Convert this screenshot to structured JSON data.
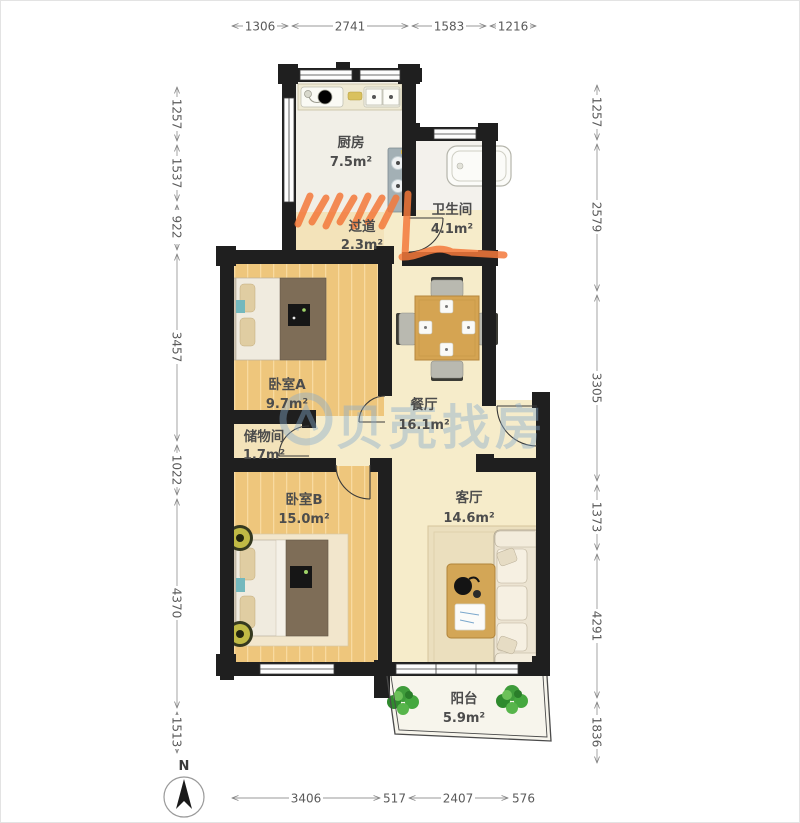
{
  "watermark": {
    "text": "贝壳找房"
  },
  "compass": {
    "label": "N"
  },
  "rooms": [
    {
      "key": "kitchen",
      "name": "厨房",
      "area": "7.5m²"
    },
    {
      "key": "bathroom",
      "name": "卫生间",
      "area": "4.1m²"
    },
    {
      "key": "hallway",
      "name": "过道",
      "area": "2.3m²"
    },
    {
      "key": "bedroom_a",
      "name": "卧室A",
      "area": "9.7m²"
    },
    {
      "key": "storage",
      "name": "储物间",
      "area": "1.7m²"
    },
    {
      "key": "dining",
      "name": "餐厅",
      "area": "16.1m²"
    },
    {
      "key": "bedroom_b",
      "name": "卧室B",
      "area": "15.0m²"
    },
    {
      "key": "living",
      "name": "客厅",
      "area": "14.6m²"
    },
    {
      "key": "balcony",
      "name": "阳台",
      "area": "5.9m²"
    }
  ],
  "dimensions_mm": {
    "top": [
      "1306",
      "2741",
      "1583",
      "1216"
    ],
    "left": [
      "1257",
      "1537",
      "922",
      "3457",
      "1022",
      "4370",
      "1513"
    ],
    "right": [
      "1257",
      "2579",
      "3305",
      "1373",
      "4291",
      "1836"
    ],
    "bottom": [
      "3406",
      "517",
      "2407",
      "576"
    ]
  },
  "colors": {
    "wall": "#1f1f1f",
    "wood_floor": "#eec67c",
    "tile_floor": "#f1efe7",
    "cream_floor": "#f6ecca",
    "hall_floor": "#f3e3ba",
    "annotation_orange": "#f4793b",
    "watermark_blue": "#86abcd",
    "dimension_gray": "#5a5a5a"
  }
}
